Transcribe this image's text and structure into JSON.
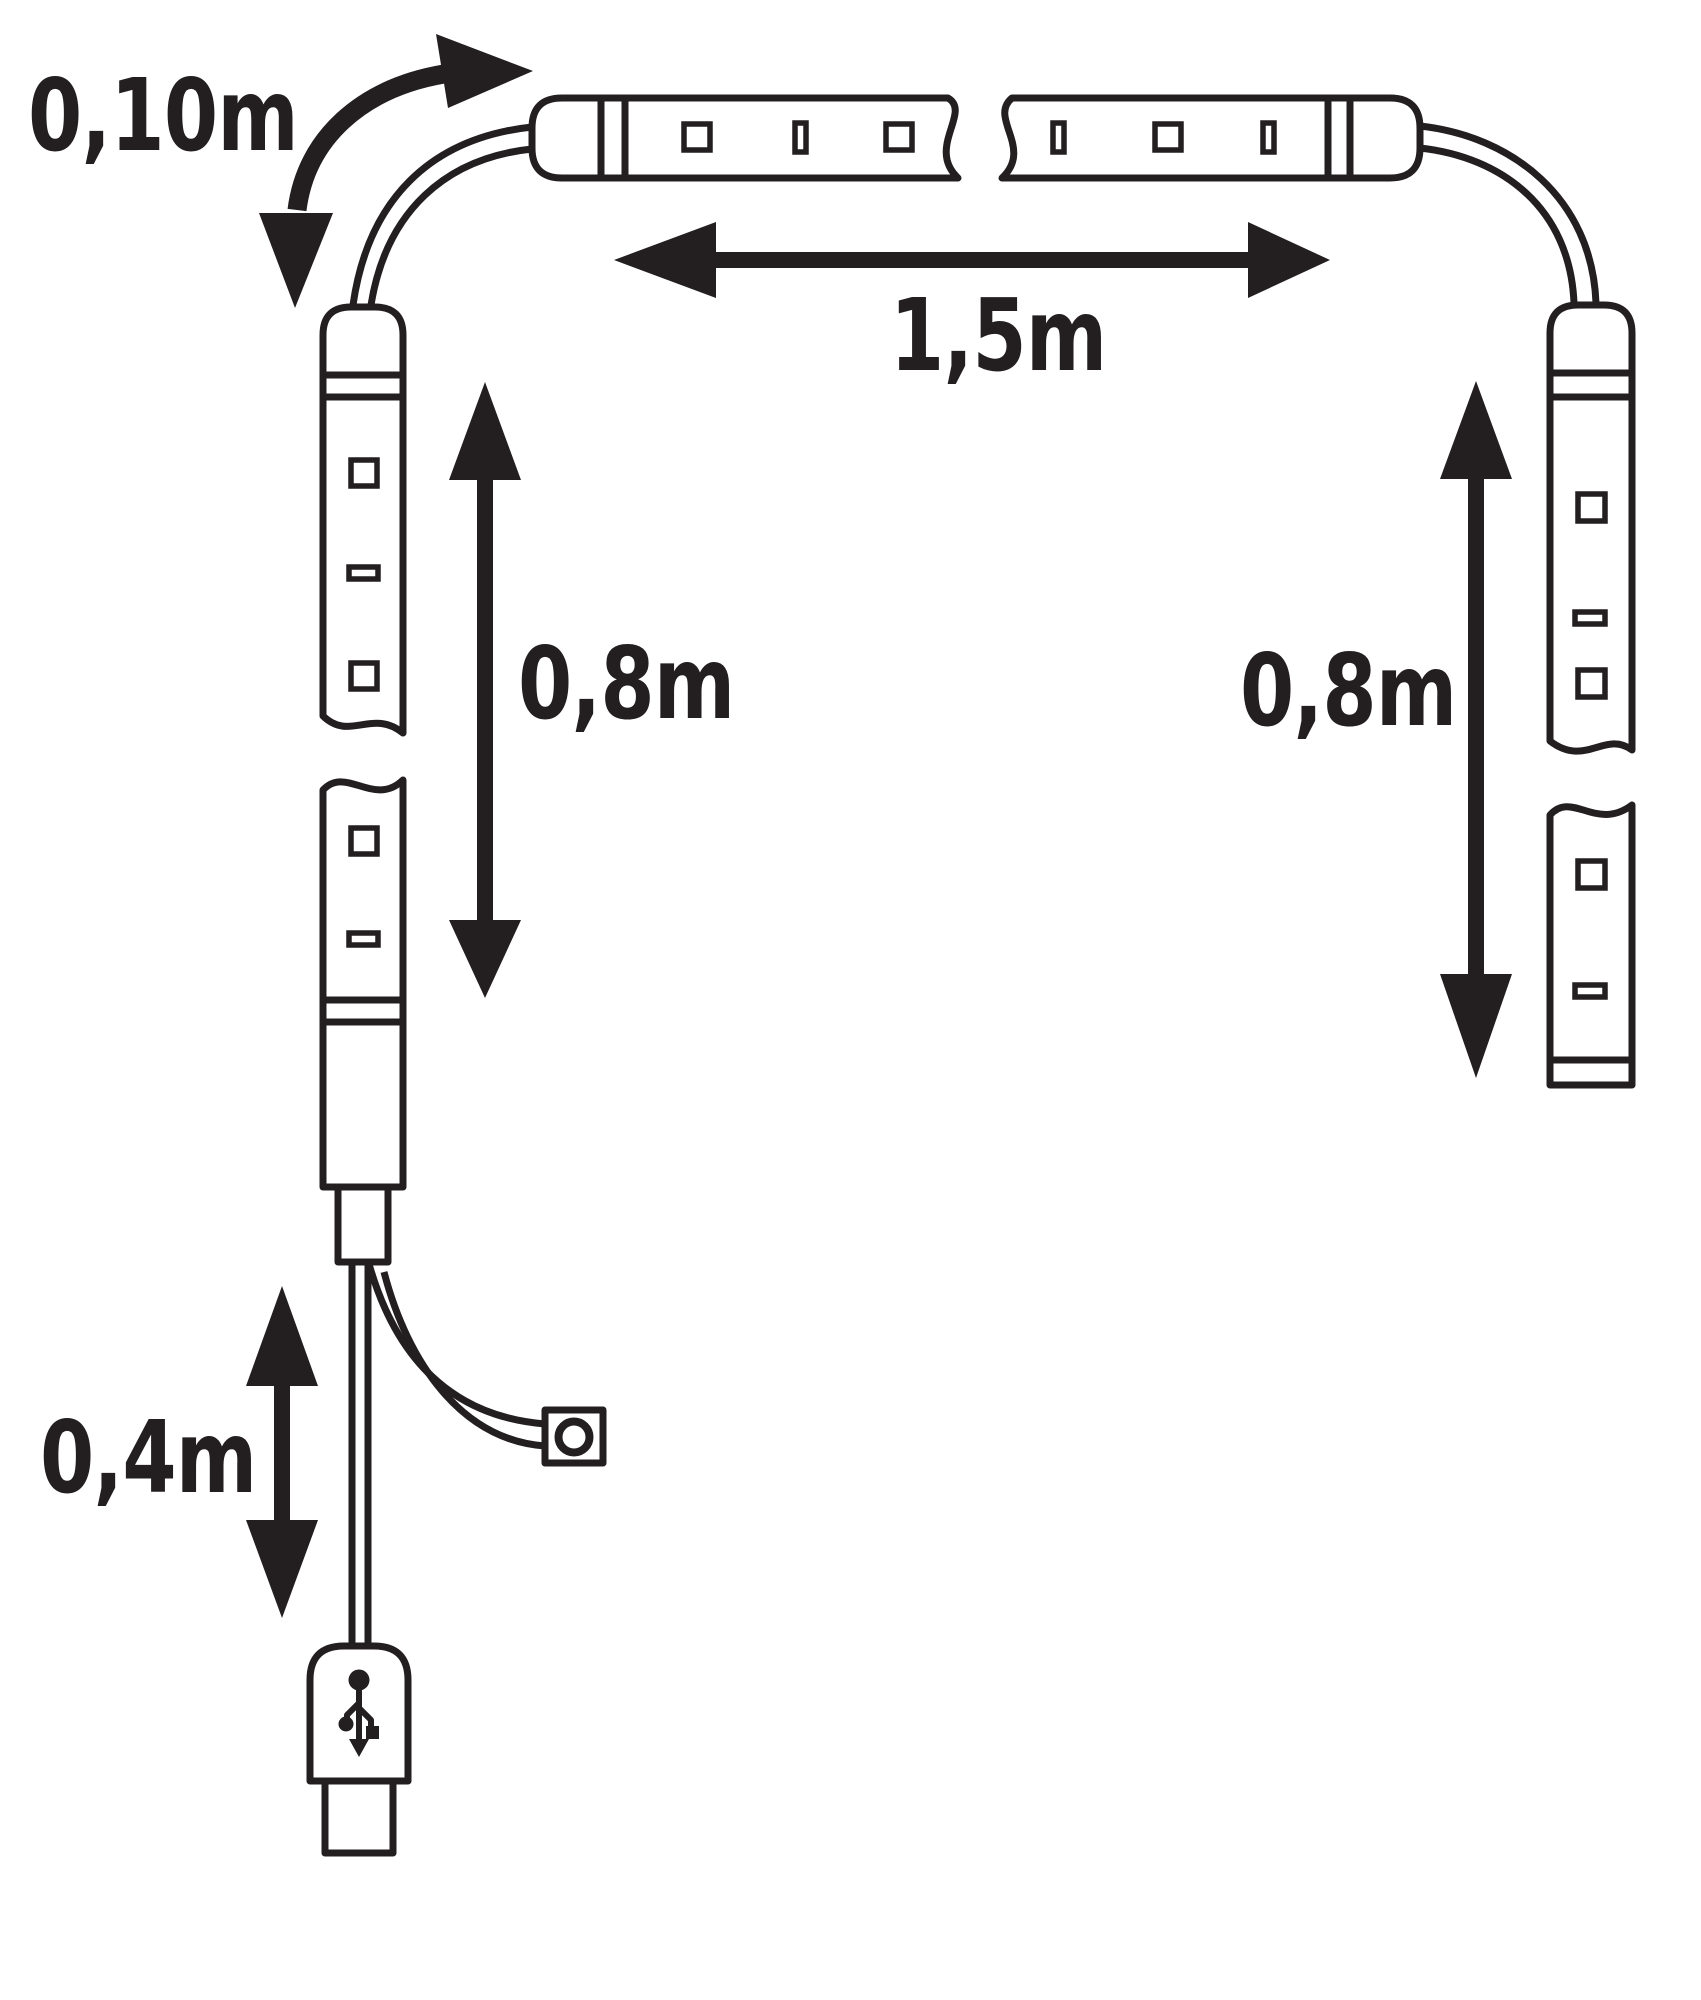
{
  "diagram": {
    "labels": {
      "top_cable_length": "0,10m",
      "horizontal_strip_length": "1,5m",
      "left_strip_length": "0,8m",
      "right_strip_length": "0,8m",
      "usb_cable_length": "0,4m"
    },
    "colors": {
      "line": "#231f20",
      "background": "#ffffff"
    },
    "icons": {
      "usb": "usb-trident-icon",
      "switch": "round-button-icon"
    }
  }
}
